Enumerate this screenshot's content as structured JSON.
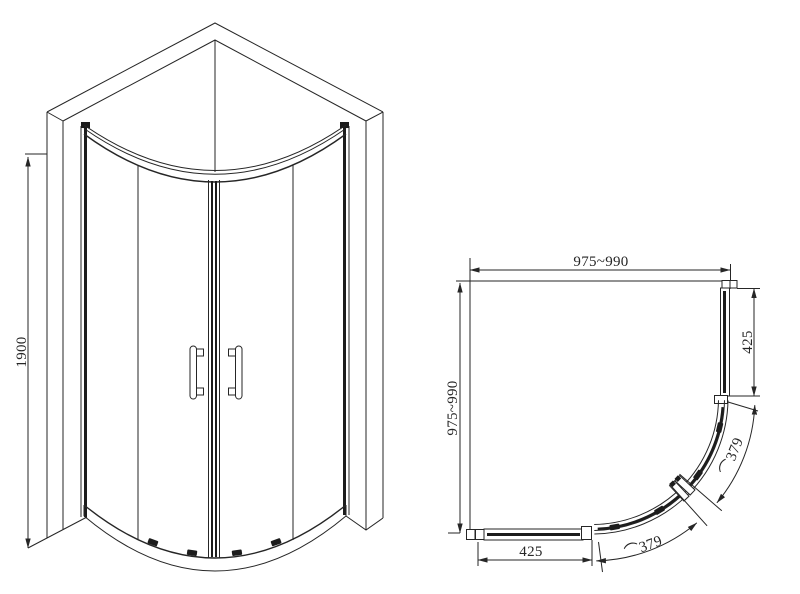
{
  "dims": {
    "front_height": "1900",
    "plan_width": "975~990",
    "plan_depth": "975~990",
    "side_panel_depth": "425",
    "front_panel_width": "425",
    "arc_symbol": "⌒",
    "door_arc_left": "379",
    "door_arc_right": "379"
  },
  "colors": {
    "line": "#262626",
    "background": "#ffffff"
  }
}
